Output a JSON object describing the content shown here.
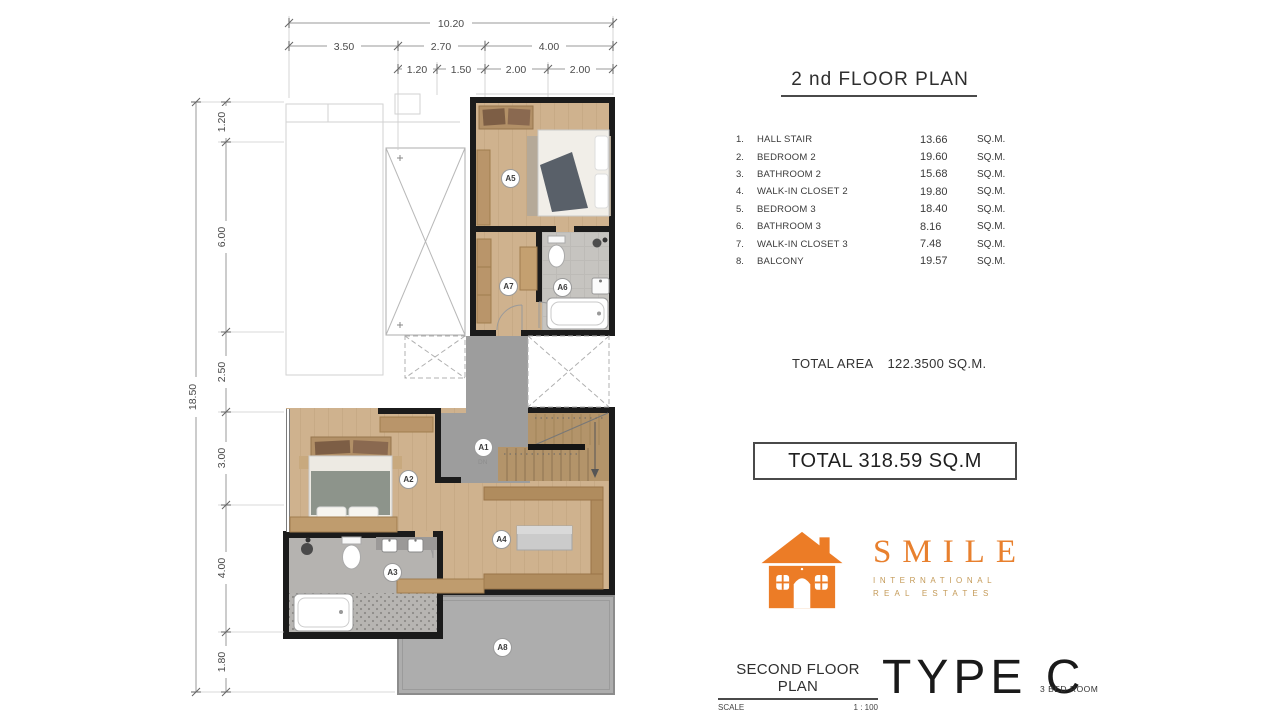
{
  "plan": {
    "void_label": "VOID",
    "stair_label": "DN",
    "room_labels": [
      "A1",
      "A2",
      "A3",
      "A4",
      "A5",
      "A6",
      "A7",
      "A8"
    ],
    "dims": {
      "top_total": "10.20",
      "top_mid": [
        "3.50",
        "2.70",
        "4.00"
      ],
      "top_inner": [
        "1.20",
        "1.50",
        "2.00",
        "2.00"
      ],
      "left_total": "18.50",
      "left_inner": [
        "1.20",
        "6.00",
        "2.50",
        "3.00",
        "4.00",
        "1.80"
      ]
    }
  },
  "panel": {
    "title": "2 nd FLOOR PLAN",
    "rooms": [
      {
        "no": "1.",
        "name": "HALL STAIR",
        "area": "13.66",
        "unit": "SQ.M."
      },
      {
        "no": "2.",
        "name": "BEDROOM 2",
        "area": "19.60",
        "unit": "SQ.M."
      },
      {
        "no": "3.",
        "name": "BATHROOM 2",
        "area": "15.68",
        "unit": "SQ.M."
      },
      {
        "no": "4.",
        "name": "WALK-IN CLOSET 2",
        "area": "19.80",
        "unit": "SQ.M."
      },
      {
        "no": "5.",
        "name": "BEDROOM 3",
        "area": "18.40",
        "unit": "SQ.M."
      },
      {
        "no": "6.",
        "name": "BATHROOM 3",
        "area": "8.16",
        "unit": "SQ.M."
      },
      {
        "no": "7.",
        "name": "WALK-IN CLOSET 3",
        "area": "7.48",
        "unit": "SQ.M."
      },
      {
        "no": "8.",
        "name": "BALCONY",
        "area": "19.57",
        "unit": "SQ.M."
      }
    ],
    "total_area_label": "TOTAL AREA",
    "total_area_value": "122.3500 SQ.M.",
    "grand_total_label": "TOTAL 318.59 SQ.M",
    "logo": {
      "brand": "SMILE",
      "sub1": "INTERNATIONAL",
      "sub2": "REAL ESTATES"
    },
    "footer": {
      "plan_name": "SECOND FLOOR PLAN",
      "scale_label": "SCALE",
      "scale_value": "1 : 100",
      "type_label": "TYPE C",
      "bed_label": "3 BED ROOM"
    }
  },
  "colors": {
    "accent_orange": "#E8802E",
    "gold": "#C49A58",
    "wall": "#1B1B1B",
    "wood": "#CFB28E",
    "wood_dark": "#B28C5E",
    "hall_gray": "#9D9D9D",
    "balcony_gray": "#ADADAD"
  }
}
